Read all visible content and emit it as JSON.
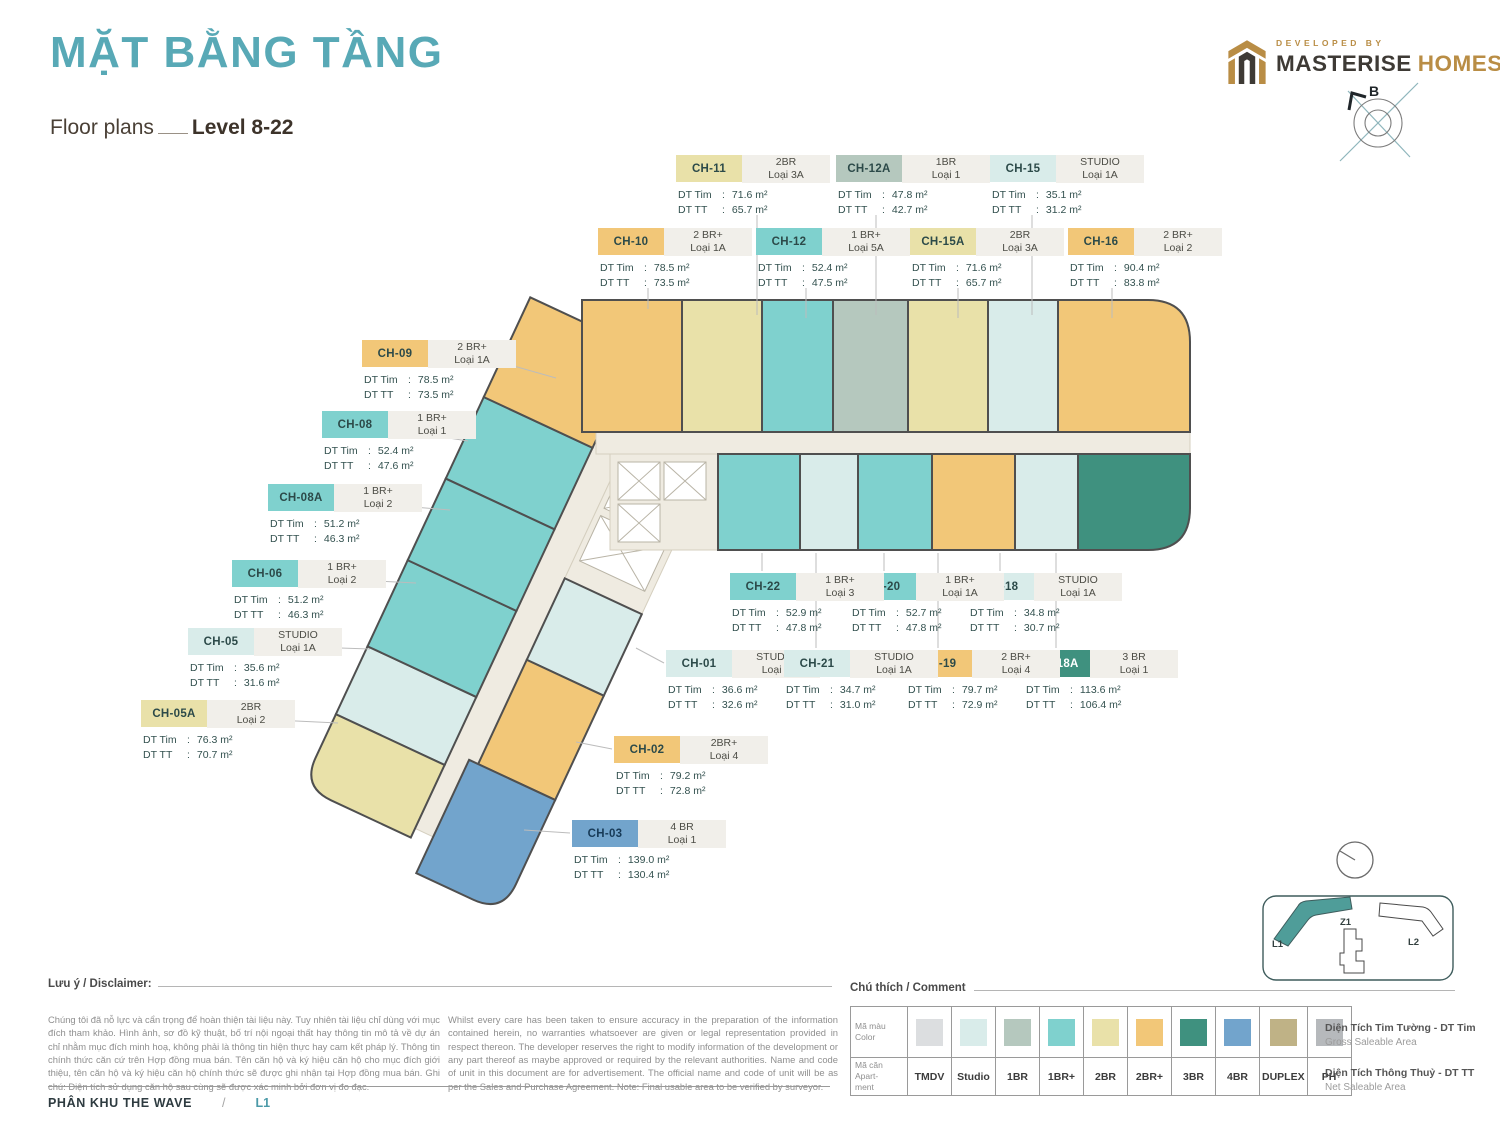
{
  "header": {
    "title": "MẶT BẰNG TẦNG",
    "subtitle": "Floor plans",
    "level": "Level 8-22",
    "developed_by": "DEVELOPED BY",
    "brand_dark": "MASTERISE",
    "brand_gold": "HOMES",
    "compass_label": "B"
  },
  "labels": {
    "area_tim": "DT Tim",
    "area_tt": "DT TT",
    "colon": ":"
  },
  "units": [
    {
      "code": "CH-01",
      "cat": "Studio",
      "type": "STUDIO",
      "loai": "Loại 4",
      "tim": "36.6 m²",
      "tt": "32.6 m²"
    },
    {
      "code": "CH-02",
      "cat": "2BR+",
      "type": "2BR+",
      "loai": "Loại 4",
      "tim": "79.2 m²",
      "tt": "72.8 m²"
    },
    {
      "code": "CH-03",
      "cat": "4BR",
      "type": "4 BR",
      "loai": "Loại 1",
      "tim": "139.0 m²",
      "tt": "130.4 m²",
      "tx": "#173a57"
    },
    {
      "code": "CH-05",
      "cat": "Studio",
      "type": "STUDIO",
      "loai": "Loại 1A",
      "tim": "35.6 m²",
      "tt": "31.6 m²"
    },
    {
      "code": "CH-05A",
      "cat": "2BR",
      "type": "2BR",
      "loai": "Loại 2",
      "tim": "76.3 m²",
      "tt": "70.7 m²"
    },
    {
      "code": "CH-06",
      "cat": "1BR+",
      "type": "1 BR+",
      "loai": "Loại 2",
      "tim": "51.2 m²",
      "tt": "46.3 m²"
    },
    {
      "code": "CH-08",
      "cat": "1BR+",
      "type": "1 BR+",
      "loai": "Loại 1",
      "tim": "52.4 m²",
      "tt": "47.6 m²"
    },
    {
      "code": "CH-08A",
      "cat": "1BR+",
      "type": "1 BR+",
      "loai": "Loại 2",
      "tim": "51.2 m²",
      "tt": "46.3 m²"
    },
    {
      "code": "CH-09",
      "cat": "2BR+",
      "type": "2 BR+",
      "loai": "Loại 1A",
      "tim": "78.5 m²",
      "tt": "73.5 m²"
    },
    {
      "code": "CH-10",
      "cat": "2BR+",
      "type": "2 BR+",
      "loai": "Loại 1A",
      "tim": "78.5 m²",
      "tt": "73.5 m²"
    },
    {
      "code": "CH-11",
      "cat": "2BR",
      "type": "2BR",
      "loai": "Loại 3A",
      "tim": "71.6 m²",
      "tt": "65.7 m²"
    },
    {
      "code": "CH-12",
      "cat": "1BR+",
      "type": "1 BR+",
      "loai": "Loại 5A",
      "tim": "52.4 m²",
      "tt": "47.5 m²"
    },
    {
      "code": "CH-12A",
      "cat": "1BR",
      "type": "1BR",
      "loai": "Loại 1",
      "tim": "47.8 m²",
      "tt": "42.7 m²"
    },
    {
      "code": "CH-15",
      "cat": "Studio",
      "type": "STUDIO",
      "loai": "Loại 1A",
      "tim": "35.1 m²",
      "tt": "31.2 m²"
    },
    {
      "code": "CH-15A",
      "cat": "2BR",
      "type": "2BR",
      "loai": "Loại 3A",
      "tim": "71.6 m²",
      "tt": "65.7 m²"
    },
    {
      "code": "CH-16",
      "cat": "2BR+",
      "type": "2 BR+",
      "loai": "Loại 2",
      "tim": "90.4 m²",
      "tt": "83.8 m²"
    },
    {
      "code": "CH-18",
      "cat": "Studio",
      "type": "STUDIO",
      "loai": "Loại 1A",
      "tim": "34.8 m²",
      "tt": "30.7 m²"
    },
    {
      "code": "CH-18A",
      "cat": "3BR",
      "type": "3 BR",
      "loai": "Loại 1",
      "tim": "113.6 m²",
      "tt": "106.4 m²",
      "tx": "#ffffff"
    },
    {
      "code": "CH-19",
      "cat": "2BR+",
      "type": "2 BR+",
      "loai": "Loại 4",
      "tim": "79.7 m²",
      "tt": "72.9 m²"
    },
    {
      "code": "CH-20",
      "cat": "1BR+",
      "type": "1 BR+",
      "loai": "Loại 1A",
      "tim": "52.7 m²",
      "tt": "47.8 m²"
    },
    {
      "code": "CH-21",
      "cat": "Studio",
      "type": "STUDIO",
      "loai": "Loại 1A",
      "tim": "34.7 m²",
      "tt": "31.0 m²"
    },
    {
      "code": "CH-22",
      "cat": "1BR+",
      "type": "1 BR+",
      "loai": "Loại 3",
      "tim": "52.9 m²",
      "tt": "47.8 m²"
    }
  ],
  "legend": {
    "heading": "Chú thích / Comment",
    "row_color_label": [
      "Mã màu",
      "Color"
    ],
    "row_code_label": [
      "Mã căn",
      "Apart-",
      "ment"
    ],
    "items": [
      {
        "code": "TMDV",
        "color": "#dcdee0"
      },
      {
        "code": "Studio",
        "color": "#d9ecea"
      },
      {
        "code": "1BR",
        "color": "#b5c8be"
      },
      {
        "code": "1BR+",
        "color": "#7fd1ce"
      },
      {
        "code": "2BR",
        "color": "#e9e1a9"
      },
      {
        "code": "2BR+",
        "color": "#f2c778"
      },
      {
        "code": "3BR",
        "color": "#3f917f"
      },
      {
        "code": "4BR",
        "color": "#72a4cc"
      },
      {
        "code": "DUPLEX",
        "color": "#bfb286"
      },
      {
        "code": "PH",
        "color": "#b6b9bc"
      }
    ]
  },
  "disclaimer": {
    "heading": "Lưu ý / Disclaimer:",
    "vi": "Chúng tôi đã nỗ lực và cẩn trọng để hoàn thiện tài liệu này. Tuy nhiên tài liệu chỉ dùng với mục đích tham khảo. Hình ảnh, sơ đồ kỹ thuật, bố trí nội ngoại thất hay thông tin mô tả về dự án chỉ nhằm mục đích minh hoạ, không phải là thông tin hiện thực hay cam kết pháp lý. Thông tin chính thức căn cứ trên Hợp đồng mua bán. Tên căn hộ và ký hiệu căn hộ cho mục đích giới thiệu, tên căn hộ và ký hiệu căn hộ chính thức sẽ được ghi nhận tại Hợp đồng mua bán. Ghi chú: Diện tích sử dụng căn hộ sau cùng sẽ được xác minh bởi đơn vị đo đạc.",
    "en": "Whilst every care has been taken to ensure accuracy in the preparation of the information contained herein, no warranties whatsoever are given or legal representation provided in respect thereon. The developer reserves the right to modify information of the development or any part thereof as maybe approved or required by the relevant authorities. Name and code of unit in this document are for advertisement. The official name and code of unit will be as per the Sales and Purchase Agreement. Note: Final usable area to be verified by surveyor."
  },
  "area_defs": [
    {
      "vi": "Diện Tích Tim Tường - DT Tim",
      "en": "Gross Saleable Area"
    },
    {
      "vi": "Diện Tích Thông Thuỷ - DT TT",
      "en": "Net Saleable Area"
    }
  ],
  "footer": {
    "zone": "PHÂN KHU THE WAVE",
    "slash": "/",
    "tower": "L1"
  },
  "minimap": {
    "l1": "L1",
    "z1": "Z1",
    "l2": "L2"
  },
  "colors": {
    "title_teal": "#58a9b6",
    "brand_gold": "#b98d45",
    "brand_dark": "#3e3a35",
    "corridor": "#efebe1",
    "wall": "#4f4f4f",
    "footer_tower": "#4b9aa8"
  }
}
